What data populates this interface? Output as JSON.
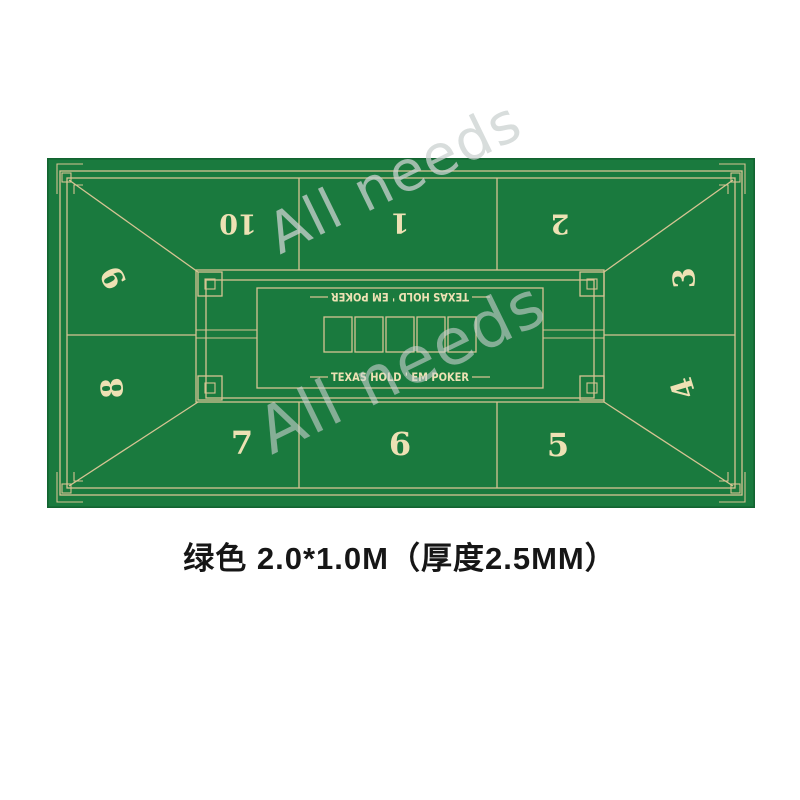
{
  "colors": {
    "felt_green": "#1a7a3e",
    "line_beige": "#d6c493",
    "number_cream": "#eee1b4",
    "caption_text": "#161616",
    "wm_ink": "#ccd2d1",
    "page_bg": "#ffffff"
  },
  "mat": {
    "brand_text_top": "TEXAS HOLD ' EM POKER",
    "brand_text_bottom": "TEXAS HOLD ' EM POKER",
    "card_slots": 5,
    "seats": [
      {
        "label": "1"
      },
      {
        "label": "2"
      },
      {
        "label": "3"
      },
      {
        "label": "4"
      },
      {
        "label": "5"
      },
      {
        "label": "6"
      },
      {
        "label": "7"
      },
      {
        "label": "8"
      },
      {
        "label": "9"
      },
      {
        "label": "10"
      }
    ]
  },
  "watermark": {
    "text_top": "All needs",
    "text_center": "All needs"
  },
  "caption": {
    "text": "绿色  2.0*1.0M（厚度2.5MM）"
  }
}
